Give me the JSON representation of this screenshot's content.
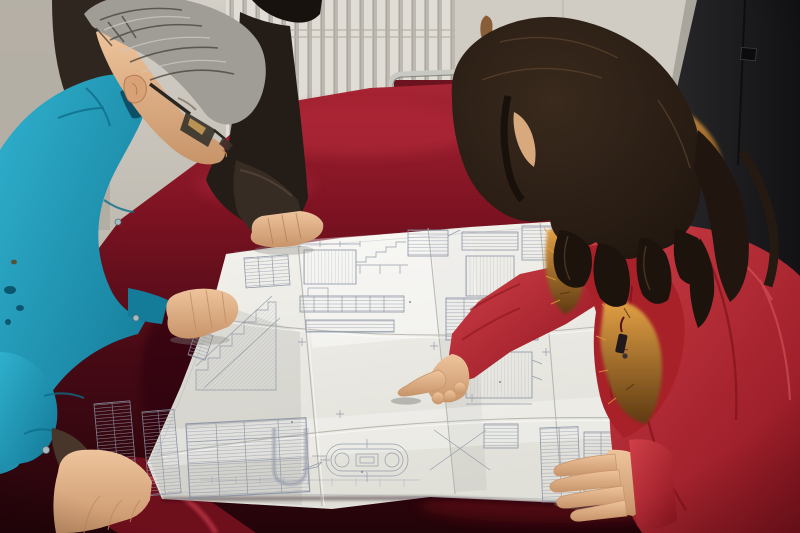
{
  "scene": {
    "description": "Photograph: three people lean over a large folded construction blueprint spread on a table covered with dark red velvet cloth.",
    "people": [
      {
        "id": "left-worker",
        "description": "middle-aged man with gray hair and dark-rimmed eyeglasses wearing a teal work jacket, both hands resting on the table and drawing"
      },
      {
        "id": "top-colleague",
        "description": "person in a dark jacket, head cropped at top of frame, one hand resting on the top edge of the drawing"
      },
      {
        "id": "right-woman",
        "description": "woman with long dark wavy hair in a red padded coat with orange fur-trimmed hood, pointing at the drawing with her right index finger"
      }
    ],
    "objects": [
      {
        "id": "blueprint",
        "description": "large white folded technical drawing with stair sections, detail schedules, dimension lines and an oval tank detail; lettering too small to read"
      },
      {
        "id": "table",
        "description": "table draped in dark red velvet cloth"
      },
      {
        "id": "chair",
        "description": "chrome-framed chair with red upholstered back behind the table"
      },
      {
        "id": "radiator",
        "description": "white wall radiator with vertical fins"
      },
      {
        "id": "door",
        "description": "dark door at the right edge with small latch plate"
      },
      {
        "id": "wall",
        "description": "light warm-gray wall with small rust stain"
      }
    ]
  },
  "colors": {
    "wall": "#c6c2b9",
    "wall_left": "#b1aca2",
    "radiator_light": "#dbd8d1",
    "radiator_shadow": "#b2ada3",
    "wall_right": "#d0ccc4",
    "rust": "#7c4a20",
    "door": "#1c1c1e",
    "door_frame": "#a9a59c",
    "chair_chrome": "#c9c9c4",
    "chair_back": "#6b1420",
    "cloth_bright": "#a82534",
    "cloth_mid": "#7e1322",
    "cloth_dark": "#470a15",
    "cloth_deep": "#230409",
    "paper_light": "#f4f3ee",
    "paper_dark": "#e0dfd8",
    "ink": "#8890a2",
    "teal_light": "#2fb0cd",
    "teal_dark": "#127795",
    "dark_jacket": "#2f271f",
    "gray_hair_light": "#a09d97",
    "gray_hair_dark": "#4a4640",
    "skin_light": "#eec49c",
    "skin_dark": "#c8946a",
    "coat_light": "#d04048",
    "coat_dark": "#8e1420",
    "hood": "#a82028",
    "fur_light": "#e2a045",
    "fur_dark": "#5e3a12",
    "hair_brown": "#20160f"
  }
}
